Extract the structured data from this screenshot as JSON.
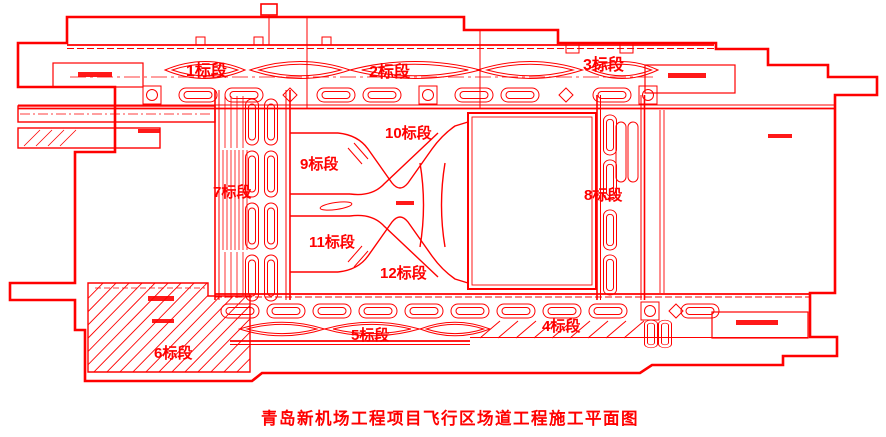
{
  "title": "青岛新机场工程项目飞行区场道工程施工平面图",
  "colors": {
    "line": "#ff0000",
    "background": "#ffffff"
  },
  "sections": {
    "s1": "1标段",
    "s2": "2标段",
    "s3": "3标段",
    "s4": "4标段",
    "s5": "5标段",
    "s6": "6标段",
    "s7": "7标段",
    "s8": "8标段",
    "s9": "9标段",
    "s10": "10标段",
    "s11": "11标段",
    "s12": "12标段"
  }
}
